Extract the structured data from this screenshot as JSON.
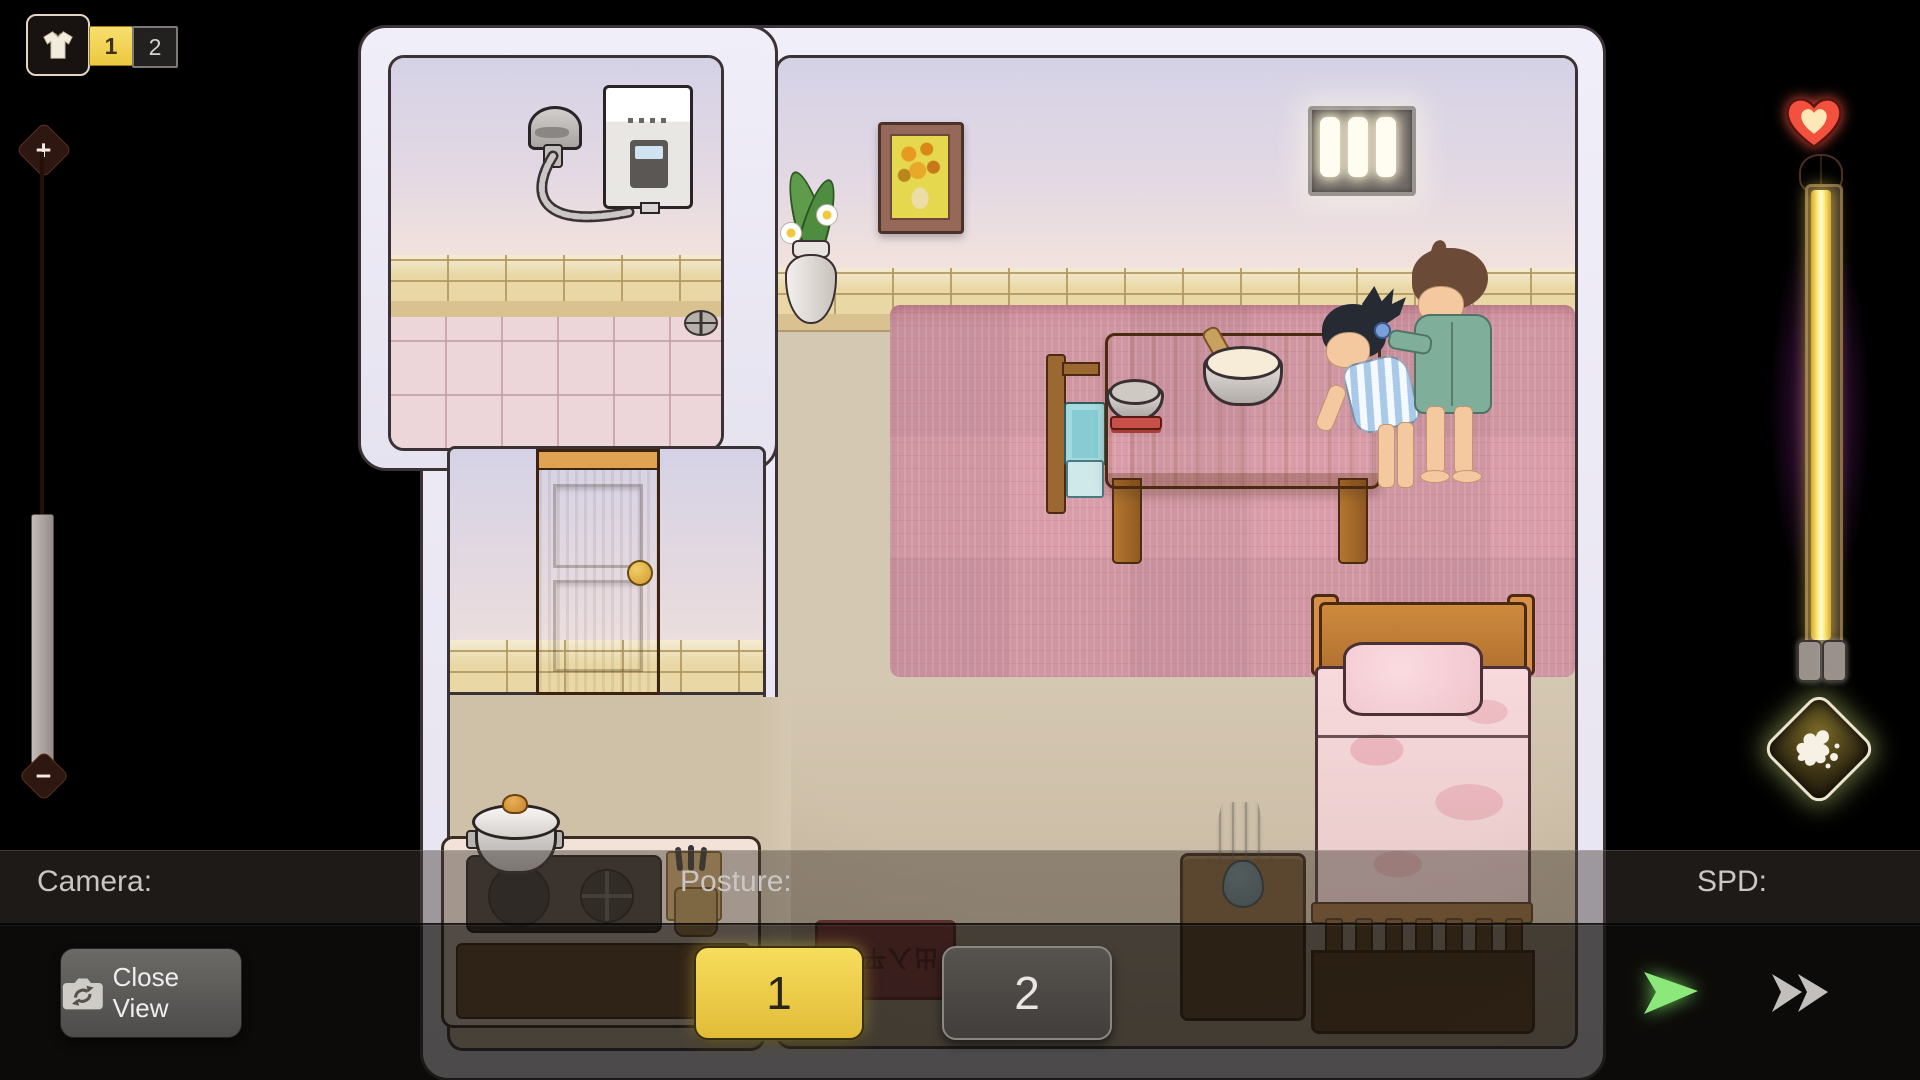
{
  "hud": {
    "outfit_bar": {
      "icon": "shirt-icon",
      "option1": "1",
      "option2": "2",
      "selected": "1"
    },
    "zoom_slider": {
      "plus": "+",
      "minus": "−"
    },
    "bottom_bar": {
      "camera_label": "Camera:",
      "close_view_label": "Close View",
      "posture_label": "Posture:",
      "posture_option1": "1",
      "posture_option2": "2",
      "posture_selected": "1",
      "spd_label": "SPD:"
    },
    "icons": {
      "outfit": "shirt-icon",
      "zoom_in": "plus-icon",
      "zoom_out": "minus-icon",
      "affection": "heart-icon",
      "climax": "splash-diamond-icon",
      "camera_swap": "camera-swap-icon",
      "play": "play-arrow-icon",
      "fast_forward": "fast-forward-icon"
    }
  },
  "scene": {
    "doormat_text": "出入平安",
    "objects": [
      "shower",
      "water-heater",
      "drain",
      "sunflower-painting",
      "flower-vase",
      "window",
      "wooden-door",
      "dining-table",
      "porridge-bowl",
      "small-bowl",
      "chopsticks",
      "chair",
      "girl-character",
      "boy-character",
      "bed",
      "nightstand",
      "lamp",
      "kitchen-counter",
      "stove",
      "cooking-pot",
      "knife-block",
      "doormat",
      "pink-rug"
    ]
  },
  "colors": {
    "accent_yellow": "#f0d04a",
    "hud_green": "#8ce87a",
    "gauge_yellow": "#ffe96a",
    "gauge_glow_purple": "#8c28a0",
    "heart_red": "#f4503e",
    "rug_pink": "#d99ca9",
    "wall_white": "#eceaf4"
  }
}
